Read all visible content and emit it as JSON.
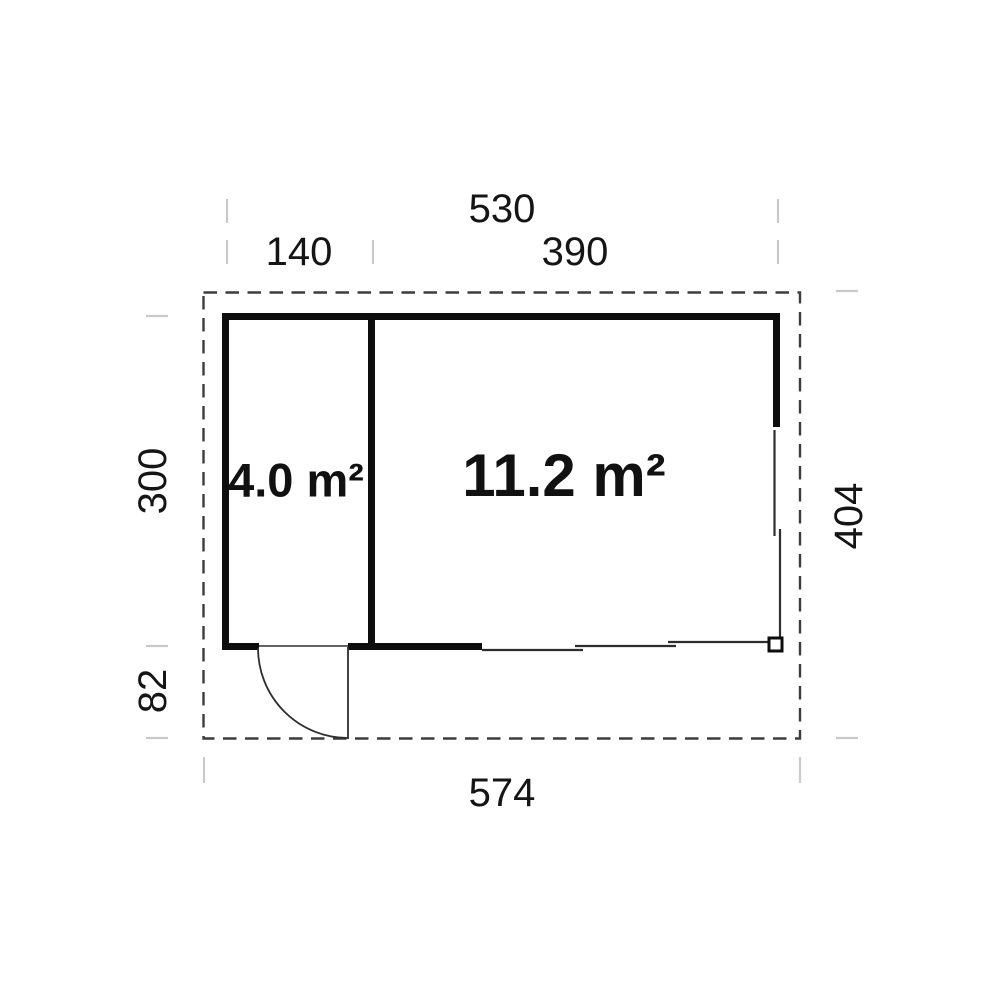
{
  "floor_plan": {
    "type": "floor-plan",
    "dimensions": {
      "top_total": "530",
      "top_left_section": "140",
      "top_right_section": "390",
      "left_depth": "300",
      "left_front_depth": "82",
      "right_total_depth": "404",
      "bottom_total_width": "574"
    },
    "rooms": {
      "small": {
        "area_label": "4.0 m²"
      },
      "large": {
        "area_label": "11.2 m²"
      }
    },
    "features": {
      "door": "swing-door-bottom-left",
      "sliding_panels": "right-and-bottom-right",
      "corner_post": "bottom-right-square"
    },
    "colors": {
      "wall": "#0d0d0d",
      "dashed_outline": "#3c3c3c",
      "tick": "#c9c9c9",
      "text": "#151515",
      "background": "#ffffff"
    }
  }
}
